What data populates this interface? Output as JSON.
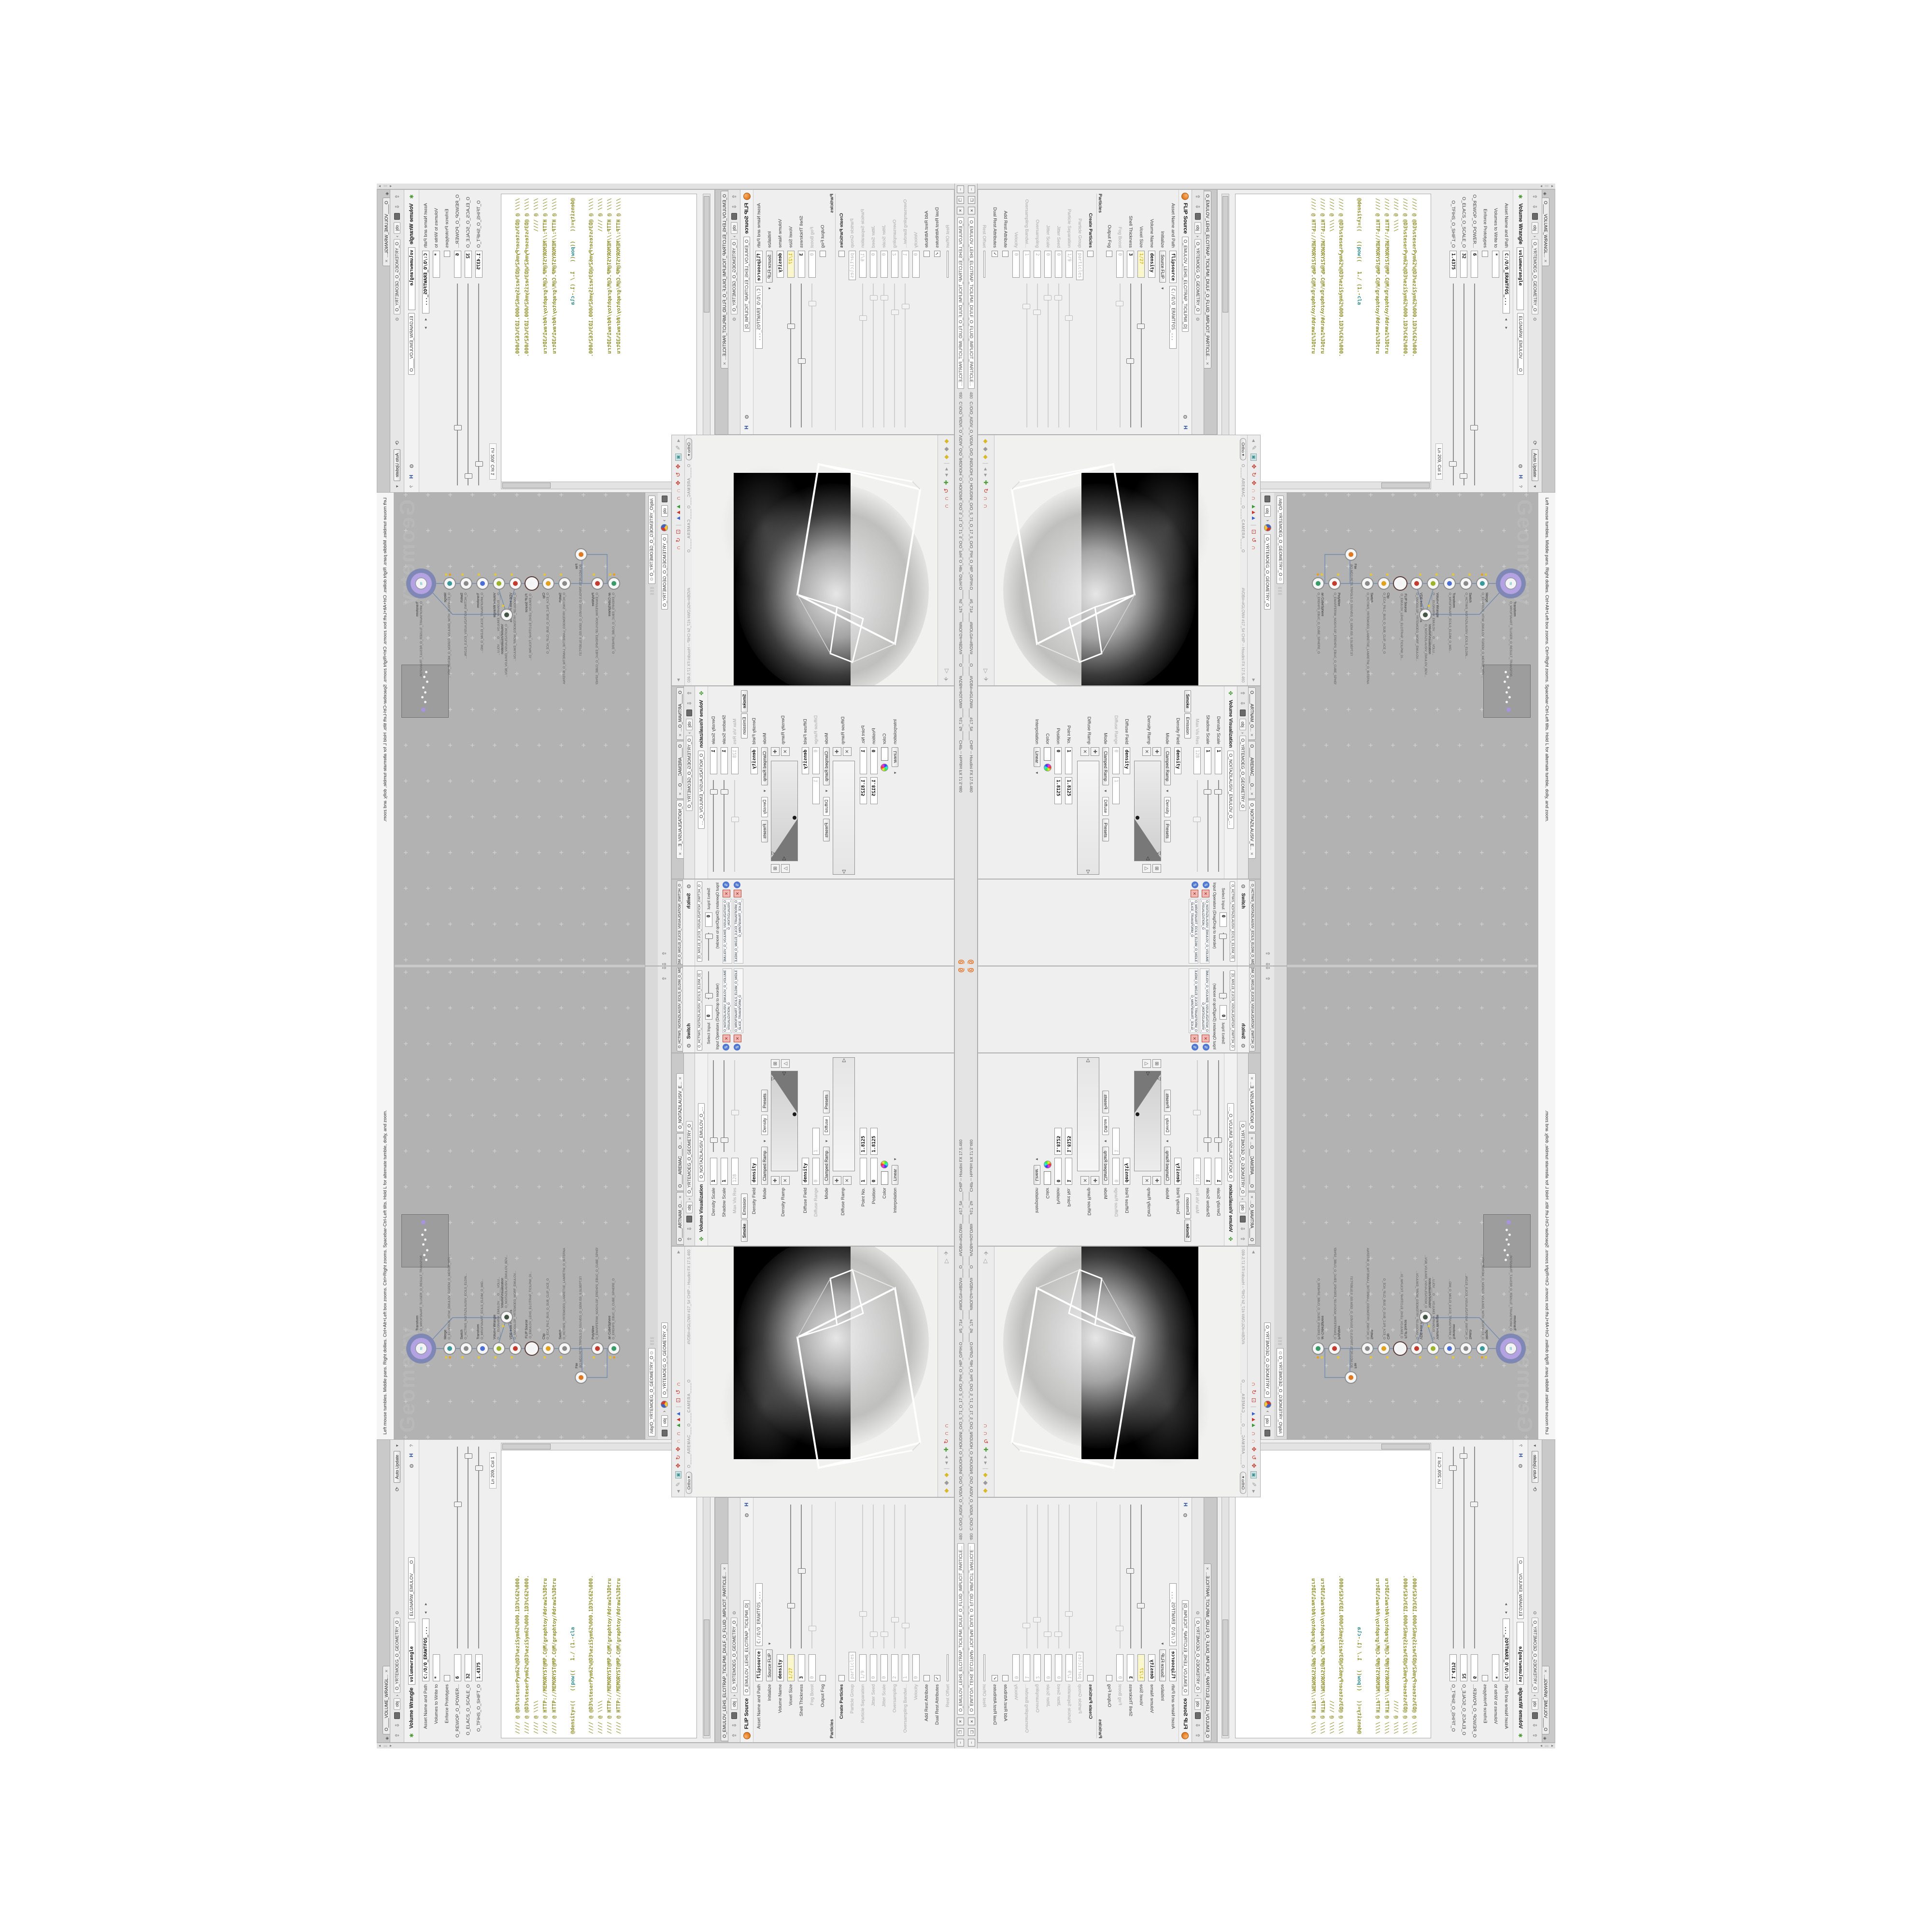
{
  "colors": {
    "accent_orange": "#e8701e",
    "network_bg": "#b2b2b2",
    "code_olive": "#8f8f2c",
    "code_teal": "#2e8f8f",
    "node_purple": "#b4a3e2",
    "node_purple_ring": "#7f88b5",
    "yellow_field": "#fbf7cd",
    "render_black": "#000000"
  },
  "status": {
    "viewport_help": "Left mouse tumbles. Middle pans. Right dollies. Ctrl+Alt+Left box zooms. Ctrl+Right zooms. Spacebar-Ctrl-Left tilts. Hold L for alternate tumble, dolly, and zoom.",
    "win_min": "–",
    "win_restore": "❐",
    "win_close": "✕"
  },
  "titlebar": {
    "tab": "O_EMULOV_LEHS_ELCITRAP_TICILPMI_DIULF_O_FLUID_IMPLICIT_PARTICLE...",
    "num": "480",
    "path": "C:/O/O_AIDIV_O_VIDIA_O/O_INIDUOH_O_HOUDINI_O/O_5_71_O_17_5_O/O_PIH_O_HIP_O/PIH.O____#5_71#____#WOLG#=#BDV#____O____#VDB#=#GLOW#____#17_5#____CHIP -- Houdini FX 17.5.460"
  },
  "wrangle": {
    "tab": "O____VOLUME_WRANGL...",
    "tab_close": "✕",
    "auto_update": "Auto Update",
    "crumb_obj": "obj",
    "crumb_path": "O_YRTEMOEG_O_GEOMETRY_O",
    "title": "Volume Wrangle",
    "name": "volumewrangle",
    "name_mirror": "ELGNARW_EMULOV____O",
    "asset_label": "Asset Name and Path",
    "asset_value": "C:/O/O_ERAWTFOS_...",
    "rows": [
      {
        "label": "Volumes to Write to",
        "value": "*"
      },
      {
        "label": "Enforce Prototypes",
        "value": ""
      },
      {
        "label": "O_REWOP_O_POWER...",
        "value": "6"
      },
      {
        "label": "O_ELACS_O_SCALE_O",
        "value": "32"
      },
      {
        "label": "O_TFIHS_O_SHIFT_O",
        "value": "1.4375"
      }
    ],
    "cursor": "Ln 209, Col 1",
    "code": [
      "//// @ @D3%steserPym62%@D3%eziSym62%000.1D3%C62%000.",
      "//// @ @D3%steserPym62%@D3%eziSym62%000.1D3%C62%000.",
      "//// @ \\\\\\\\",
      "//// @ HTTP://MEMORYST@MP.C@M/graphtoy/#draw1%3Dtru",
      "//// @ HTTP://MEMORYST@MP.C@M/graphtoy/#draw1%3Dtru",
      ""
    ],
    "code7a": "@density=((   ((",
    "code7b": "pow",
    "code7c": "((   1./ (1.-",
    "code7d": "cla",
    "code2": [
      "//// @ @D3%steserPym62%@D3%eziSym62%000.1D3%C62%000.",
      "//// @ \\\\\\\\",
      "//// @ HTTP://MEMORYST@MP.C@M/graphtoy/#draw1%3Dtru",
      "//// @ HTTP://MEMORYST@MP.C@M/graphtoy/#draw1%3Dtru"
    ]
  },
  "network": {
    "watermark": "Geometry",
    "path_tab": "/obj/O_YRTEMOEG_O_GEOMETRY_O",
    "tab_obj": "obj",
    "tab_path": "O_YRTEMOEG_O_GEOMETRY_O",
    "nodes": [
      {
        "name": "an CubeSphere",
        "sub": "O_EREHPS_EBUC_O_CUBE_SPHERE_O",
        "color": "#3a9a6a"
      },
      {
        "name": "PolyWire",
        "sub": "O_EMARFERIW_NOGYLOP_EREHPS_EBUC_O_CUBE_SPHERE_POLYGON_WIREFRAME_O",
        "color": "#c33b2e"
      },
      {
        "name": "File",
        "sub": ".BO.MD3.PETS.TRPOLS.O_5SUVEG_O_GEM.IS5_0.SL0EPT.STEP.3EM.OBJ",
        "color": "#e07820"
      },
      {
        "name": "Switch",
        "sub": "O_HCTIWS_YRTEMOEG_LANRETXE_LANRETNI_O_INTERNAL_EXTERNAL_GEOMETRY_SWITCH_O",
        "color": "#8a8a8a"
      },
      {
        "name": "Clip",
        "sub": "O_ECA_PILC_BUS_O_SUB_CLIP_ACE_O",
        "color": "#e0a020"
      },
      {
        "name": "FLIP Source",
        "sub": "O_EMULOV_LEHS_ELCITRAP_TICILPMI_DI...",
        "color": "#f4f4f4"
      },
      {
        "name": "VDB from Polygons",
        "sub": "O_SNOGILOP_YRTEMOEG_MORF_EMULOV...",
        "color": "#c33b2e"
      },
      {
        "name": "Volume Wrangle",
        "sub": "O___ELGNARW_EMULOV___O___VOLU...",
        "color": "#9ab32a"
      },
      {
        "name": "VolumeVisualization",
        "sub": "O_NOITAZILAUSIV_EMULOV_BDV...",
        "color": "#445544"
      },
      {
        "name": "Transform",
        "sub": "O_MROFSNART_ECILS_ELDIM_O_MID...",
        "color": "#4a6fd0"
      },
      {
        "name": "Switch",
        "sub": "O_HCTIWS_NOITAZILAUSIV_ECILS_ELDIN...",
        "color": "#8a8a8a"
      },
      {
        "name": "Merge",
        "sub": "O_ECAFRUS_HTIW_EMULOV_EGREM_O_MERGE_VOL...",
        "color": "#3a9a9a"
      },
      {
        "name": "Transform",
        "sub": "O_MROFSNART_TLUSER_O_RESULT_TRANSFOR...",
        "color": "#2aa0b8"
      }
    ]
  },
  "flip": {
    "tab": "O_EMULOV_LEHS_ELCITRAP_TICILPMI_DIULF_O_FLUID_IMPLICIT_PARTICLE...",
    "tab_close": "✕",
    "crumb_obj": "obj",
    "crumb_path": "O_YRTEMOEG_O_GEOMETRY_O",
    "title": "FLIP Source",
    "name_chip": "O_EMULOV_LEHS_ELCITRAP_TICILPMI_D]",
    "asset_label": "Asset Name and Path",
    "asset_name": "flipsource",
    "asset_path": "C:/O/O_ERAWTFOS_...",
    "rows": [
      {
        "label": "Initialize",
        "value": "Source FLIP"
      },
      {
        "label": "Volume Name",
        "value": "density"
      },
      {
        "label": "Voxel Size",
        "value": "1/27"
      },
      {
        "label": "Shell Thickness",
        "value": "3"
      },
      {
        "label": "Fog Boost",
        "value": "0"
      },
      {
        "label": "Output Fog",
        "value": ""
      },
      {
        "label": "Particles",
        "value": ""
      },
      {
        "label": "Create Particles",
        "value": ""
      },
      {
        "label": "Particle Group",
        "value": "particles"
      },
      {
        "label": "Particle Separation",
        "value": "1/9"
      },
      {
        "label": "Jitter Seed",
        "value": "0"
      },
      {
        "label": "Jitter Scale",
        "value": "0"
      },
      {
        "label": "Oversampling",
        "value": "2"
      },
      {
        "label": "Oversampling Bandwi...",
        "value": "1"
      },
      {
        "label": "Velocity",
        "value": "0"
      },
      {
        "label": "Add Rest Attribute",
        "value": ""
      },
      {
        "label": "Dual Rest Attributes",
        "value": "✓"
      },
      {
        "label": "Rest Offset",
        "value": ""
      }
    ]
  },
  "viewport": {
    "camera_strip": "O____AREMAC___O____CAMERA____O",
    "ortho": "Ortho",
    "hud_right": "#VDB#=#GLOW#   #17_5#   CHIP -- Houdini FX 17.5.460"
  },
  "volviz": {
    "tab1": "O____ARTNAM_O...",
    "tab2": "O____AREMAC___O...",
    "tab3": "O_NOITAZILAUSIV_E...",
    "crumb_obj": "obj",
    "crumb_path": "O_YRTEMOEG_O_GEOMETRY_O",
    "title": "Volume Visualization",
    "name_chip": "O_NOITAZILAUSIV_EMULOV_O_VO]",
    "smoke_tab": "Smoke",
    "emission_tab": "Emission",
    "rows": [
      {
        "label": "Density Scale",
        "value": "1"
      },
      {
        "label": "Shadow Scale",
        "value": "1"
      },
      {
        "label": "Max Vis Res",
        "value": "128"
      },
      {
        "label": "Density Field",
        "value": "density"
      },
      {
        "label": "Mode",
        "value": "Clamped Ramp"
      },
      {
        "label": "Density Ramp",
        "value": ""
      },
      {
        "label": "Diffuse Field",
        "value": "density"
      },
      {
        "label": "Diffuse Range",
        "value": "0"
      },
      {
        "label": "Mode",
        "value": "Clamped Ramp"
      },
      {
        "label": "Diffuse Ramp",
        "value": ""
      },
      {
        "label": "Point No.",
        "value": "1"
      },
      {
        "label": "Position",
        "value": "0"
      },
      {
        "label": "Color",
        "value": ""
      },
      {
        "label": "Interpolation",
        "value": "Linear"
      }
    ],
    "density_word": "Density",
    "diffuse_word": "Diffuse",
    "presets": "Presets",
    "val1": "1.8125",
    "val2": "1.8125",
    "range_hi": "1"
  },
  "switch": {
    "tab": "O_HCTIWS_NOITAZILAUSIV_ECILS_ELDIM_O_MIDLE_SLICE_VISUALIZATION...",
    "title": "Switch",
    "name_chip": "O_HCTIWS_NOITAZILAUSIV_ECILS_ELDIM_O]",
    "select_label": "Select Input",
    "select_value": "0",
    "ops_label": "Input Operators (Drag/Drop to reorder)",
    "op1": "O_NOITAZILAUSIV_EMULOV_O_VOLUME_VISUALIZATION_O",
    "op2": "O_MROFSNART_ECILS_ELDIM_O_MIDLE_SLICE_TRANSFORM_O"
  }
}
